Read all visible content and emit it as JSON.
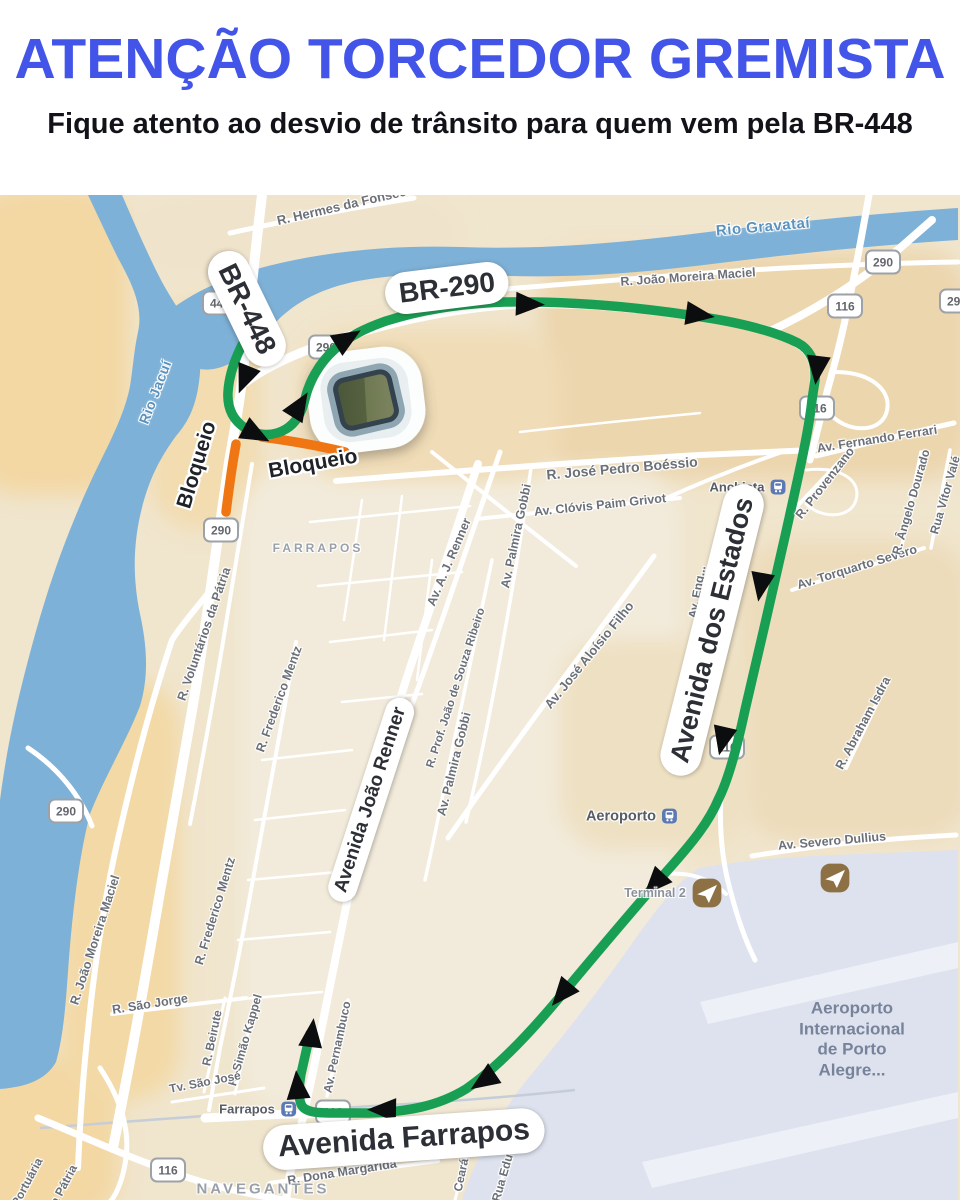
{
  "header": {
    "title": "ATENÇÃO TORCEDOR GREMISTA",
    "subtitle": "Fique atento ao desvio de trânsito para quem vem pela BR-448",
    "title_color": "#4355e8",
    "subtitle_color": "#111318"
  },
  "map": {
    "palette": {
      "base": "#f0e5cd",
      "water": "#7eb1d7",
      "airport": "#dde2ee",
      "runway": "#edf0f7",
      "road": "#ffffff",
      "route": "#199f53",
      "blocked": "#ef7612",
      "arrow": "#0c0d0f",
      "rail": "#c5cdd8"
    },
    "pills": [
      {
        "t": "BR-448",
        "x": 247,
        "y": 309,
        "r": 64,
        "s": 28
      },
      {
        "t": "BR-290",
        "x": 447,
        "y": 288,
        "r": -7,
        "s": 28
      },
      {
        "t": "Avenida dos Estados",
        "x": 712,
        "y": 630,
        "r": -76,
        "s": 27
      },
      {
        "t": "Avenida João Renner",
        "x": 371,
        "y": 800,
        "r": -72,
        "s": 19
      },
      {
        "t": "Avenida Farrapos",
        "x": 404,
        "y": 1139,
        "r": -4,
        "s": 30
      }
    ],
    "halo_labels": [
      {
        "t": "Bloqueio",
        "x": 197,
        "y": 465,
        "r": -73,
        "s": 21
      },
      {
        "t": "Bloqueio",
        "x": 313,
        "y": 464,
        "r": -10,
        "s": 21
      }
    ],
    "shields": [
      {
        "t": "448",
        "x": 220,
        "y": 303
      },
      {
        "t": "290",
        "x": 326,
        "y": 347
      },
      {
        "t": "290",
        "x": 883,
        "y": 262
      },
      {
        "t": "290",
        "x": 957,
        "y": 301
      },
      {
        "t": "116",
        "x": 845,
        "y": 306
      },
      {
        "t": "116",
        "x": 817,
        "y": 408
      },
      {
        "t": "116",
        "x": 727,
        "y": 747
      },
      {
        "t": "116",
        "x": 333,
        "y": 1112
      },
      {
        "t": "290",
        "x": 221,
        "y": 530
      },
      {
        "t": "290",
        "x": 66,
        "y": 811
      },
      {
        "t": "116",
        "x": 168,
        "y": 1170
      }
    ],
    "labels": [
      {
        "t": "R. Hermes da Fonseca",
        "x": 345,
        "y": 205,
        "r": -13,
        "s": 13,
        "c": ""
      },
      {
        "t": "R. João Moreira Maciel",
        "x": 688,
        "y": 277,
        "r": -4,
        "s": 12.5,
        "c": ""
      },
      {
        "t": "Rio Gravataí",
        "x": 763,
        "y": 227,
        "r": -5,
        "s": 15,
        "c": "lbl-water"
      },
      {
        "t": "Rio Jacuí",
        "x": 155,
        "y": 392,
        "r": -69,
        "s": 14,
        "c": "lbl-water"
      },
      {
        "t": "Av. Eng...",
        "x": 697,
        "y": 592,
        "r": -80,
        "s": 12,
        "c": ""
      },
      {
        "t": "R. José Pedro Boéssio",
        "x": 622,
        "y": 468,
        "r": -5,
        "s": 14,
        "c": ""
      },
      {
        "t": "Av. Clóvis Paim Grivot",
        "x": 600,
        "y": 505,
        "r": -6,
        "s": 12.5,
        "c": ""
      },
      {
        "t": "Av. Fernando Ferrari",
        "x": 877,
        "y": 439,
        "r": -9,
        "s": 12.5,
        "c": ""
      },
      {
        "t": "R. Provenzano",
        "x": 825,
        "y": 483,
        "r": -52,
        "s": 12.5,
        "c": ""
      },
      {
        "t": "Av. Torquarto Severo",
        "x": 857,
        "y": 567,
        "r": -17,
        "s": 12.5,
        "c": ""
      },
      {
        "t": "R. Ângelo Dourado",
        "x": 911,
        "y": 502,
        "r": -74,
        "s": 12,
        "c": ""
      },
      {
        "t": "Rua Vítor Valé",
        "x": 945,
        "y": 495,
        "r": -74,
        "s": 12,
        "c": ""
      },
      {
        "t": "R. Abraham Isdra",
        "x": 863,
        "y": 723,
        "r": -62,
        "s": 12.5,
        "c": ""
      },
      {
        "t": "Av. Severo Dullius",
        "x": 832,
        "y": 841,
        "r": -5,
        "s": 12.5,
        "c": ""
      },
      {
        "t": "R. Voluntários da Pátria",
        "x": 204,
        "y": 634,
        "r": -71,
        "s": 12.5,
        "c": ""
      },
      {
        "t": "R. Frederico Mentz",
        "x": 279,
        "y": 699,
        "r": -70,
        "s": 12.5,
        "c": ""
      },
      {
        "t": "R. Frederico Mentz",
        "x": 215,
        "y": 911,
        "r": -73,
        "s": 12.5,
        "c": ""
      },
      {
        "t": "Av. A. J. Renner",
        "x": 449,
        "y": 562,
        "r": -67,
        "s": 12.5,
        "c": ""
      },
      {
        "t": "R. Prof. João de Souza Ribeiro",
        "x": 456,
        "y": 688,
        "r": -72,
        "s": 11.5,
        "c": ""
      },
      {
        "t": "Av. Palmira Gobbi",
        "x": 516,
        "y": 536,
        "r": -78,
        "s": 12.5,
        "c": ""
      },
      {
        "t": "Av. Palmira Gobbi",
        "x": 454,
        "y": 764,
        "r": -76,
        "s": 12.5,
        "c": ""
      },
      {
        "t": "Av. José Aloísio Filho",
        "x": 589,
        "y": 655,
        "r": -51,
        "s": 13,
        "c": ""
      },
      {
        "t": "R. João Moreira Maciel",
        "x": 95,
        "y": 940,
        "r": -72,
        "s": 12.5,
        "c": ""
      },
      {
        "t": "R. São Jorge",
        "x": 150,
        "y": 1004,
        "r": -9,
        "s": 12.5,
        "c": ""
      },
      {
        "t": "R. Beirute",
        "x": 212,
        "y": 1038,
        "r": -78,
        "s": 12,
        "c": ""
      },
      {
        "t": "R. Simão Kappel",
        "x": 245,
        "y": 1040,
        "r": -74,
        "s": 12,
        "c": ""
      },
      {
        "t": "Tv. São José",
        "x": 205,
        "y": 1082,
        "r": -11,
        "s": 12,
        "c": ""
      },
      {
        "t": "Av. Pernambuco",
        "x": 337,
        "y": 1047,
        "r": -78,
        "s": 12,
        "c": ""
      },
      {
        "t": "R. Dona Margarida",
        "x": 342,
        "y": 1172,
        "r": -9,
        "s": 12.5,
        "c": ""
      },
      {
        "t": "Ceará",
        "x": 461,
        "y": 1175,
        "r": -78,
        "s": 12,
        "c": ""
      },
      {
        "t": "Rua Edu C",
        "x": 504,
        "y": 1172,
        "r": -74,
        "s": 12,
        "c": ""
      },
      {
        "t": "Portuária",
        "x": 27,
        "y": 1182,
        "r": -62,
        "s": 12,
        "c": ""
      },
      {
        "t": "da Pátria",
        "x": 62,
        "y": 1188,
        "r": -62,
        "s": 12,
        "c": ""
      },
      {
        "t": "Terminal 2",
        "x": 655,
        "y": 893,
        "r": 0,
        "s": 12.5,
        "c": "lbl-grey"
      },
      {
        "t": "FARRAPOS",
        "x": 318,
        "y": 548,
        "r": 0,
        "s": 12,
        "c": "lbl-district"
      },
      {
        "t": "NAVEGANTES",
        "x": 263,
        "y": 1189,
        "r": 0,
        "s": 15,
        "c": "lbl-district"
      }
    ],
    "pois": [
      {
        "t": "Anchieta",
        "icon": "train",
        "x": 748,
        "y": 487,
        "s": 13
      },
      {
        "t": "Aeroporto",
        "icon": "train",
        "x": 632,
        "y": 816,
        "s": 14.5
      },
      {
        "t": "Farrapos",
        "icon": "train",
        "x": 258,
        "y": 1109,
        "s": 13
      }
    ],
    "solo_icons": [
      {
        "icon": "plane",
        "x": 707,
        "y": 893,
        "s": 30
      },
      {
        "icon": "plane",
        "x": 835,
        "y": 878,
        "s": 30
      }
    ],
    "airport_block": {
      "x": 852,
      "y": 1040,
      "s": 17,
      "lines": [
        "Aeroporto",
        "Internacional",
        "de Porto",
        "Alegre..."
      ]
    },
    "arrows": [
      {
        "x": 247,
        "y": 373,
        "a": 112
      },
      {
        "x": 250,
        "y": 431,
        "a": 28
      },
      {
        "x": 296,
        "y": 411,
        "a": -58
      },
      {
        "x": 342,
        "y": 342,
        "a": -32
      },
      {
        "x": 523,
        "y": 304,
        "a": 2
      },
      {
        "x": 693,
        "y": 314,
        "a": 8
      },
      {
        "x": 818,
        "y": 363,
        "a": 97
      },
      {
        "x": 762,
        "y": 580,
        "a": 100
      },
      {
        "x": 724,
        "y": 734,
        "a": 103
      },
      {
        "x": 659,
        "y": 879,
        "a": 133
      },
      {
        "x": 566,
        "y": 989,
        "a": 130
      },
      {
        "x": 489,
        "y": 1077,
        "a": 146
      },
      {
        "x": 389,
        "y": 1110,
        "a": 181
      },
      {
        "x": 298,
        "y": 1092,
        "a": -95
      },
      {
        "x": 311,
        "y": 1040,
        "a": -83
      }
    ],
    "stadium": {
      "x": 366,
      "y": 400,
      "r": -7
    },
    "geometry": {
      "patches": [
        {
          "x": 540,
          "y": 250,
          "w": 430,
          "h": 230,
          "f": "#ecd6ae"
        },
        {
          "x": 740,
          "y": 540,
          "w": 230,
          "h": 300,
          "f": "#eddcbb"
        },
        {
          "x": -30,
          "y": 185,
          "w": 160,
          "h": 310,
          "f": "#f3d8a4"
        },
        {
          "x": -30,
          "y": 1055,
          "w": 150,
          "h": 170,
          "f": "#f3d8a4"
        },
        {
          "x": 60,
          "y": 680,
          "w": 120,
          "h": 420,
          "f": "#f3d9a6"
        },
        {
          "x": 150,
          "y": 300,
          "w": 110,
          "h": 230,
          "f": "#f2dcb0"
        },
        {
          "x": 240,
          "y": 470,
          "w": 440,
          "h": 640,
          "f": "#f2ebdb"
        },
        {
          "x": 300,
          "y": 330,
          "w": 260,
          "h": 150,
          "f": "#f0dcb6"
        },
        {
          "x": 560,
          "y": 640,
          "w": 190,
          "h": 210,
          "f": "#eee0c2"
        },
        {
          "x": 130,
          "y": 195,
          "w": 330,
          "h": 80,
          "f": "#efe3cb"
        }
      ],
      "water_jacui": "M88,195 L122,195 C135,225 148,255 162,282 C172,300 182,315 192,330 C200,342 202,360 199,382 C196,404 190,420 176,436 C160,458 148,480 140,516 C133,548 133,580 140,614 C147,646 149,676 140,706 C126,742 104,778 90,814 C80,852 73,906 69,958 C66,1000 64,1034 56,1062 C46,1080 26,1087 0,1089 L0,800 C5,762 12,724 22,684 C32,644 44,600 60,556 C74,518 88,486 102,458 C115,432 126,408 130,386 C133,368 134,350 138,332 C144,306 130,280 118,258 C108,238 98,216 88,195 Z",
      "water_gravatai": "M170,310 C200,288 235,273 285,262 C340,250 400,245 460,247 C540,250 620,243 700,233 C780,223 880,213 958,208 L958,240 C880,245 800,253 720,263 C650,272 580,278 510,276 C455,274 405,272 358,281 C322,288 296,302 278,320 C265,333 254,344 244,354 C228,368 206,374 192,366 C178,358 168,336 170,310 Z",
      "airport": "M700,868 C740,860 800,856 860,854 L958,850 L958,1200 L462,1200 C478,1152 498,1116 530,1076 C560,1040 600,990 640,932 C660,906 678,880 700,868 Z",
      "runways": [
        "M700,1002 L958,942 L958,968 L708,1024 Z",
        "M642,1162 L958,1092 L958,1118 L652,1188 Z"
      ],
      "rails": [
        "M40,1128 C150,1120 250,1112 340,1108 C430,1103 520,1096 575,1090",
        "M812,402 C804,450 792,510 779,568 C766,626 752,686 741,730"
      ],
      "roads": [
        {
          "d": "M262,195 C254,262 249,312 245,352 C241,396 236,422 229,462 L213,572 C206,622 199,672 190,722 C182,768 172,822 160,892 C148,962 136,1032 124,1092 L113,1148",
          "w": 10
        },
        {
          "d": "M209,592 C195,610 182,624 172,640 C152,700 136,760 120,830 C106,890 95,960 88,1030 C83,1075 80,1120 78,1168",
          "w": 6
        },
        {
          "d": "M28,748 C58,768 80,795 92,826",
          "w": 5
        },
        {
          "d": "M246,382 C262,370 290,355 330,342 C380,325 440,310 505,305 C575,300 660,310 730,322 C762,327 786,336 800,345 C812,353 816,365 814,385",
          "w": 9
        },
        {
          "d": "M814,385 C810,425 798,478 786,532 C774,586 758,654 745,710 C736,752 728,780 719,798 C709,822 693,842 667,871 C639,903 599,950 559,998 C524,1040 494,1070 466,1089 C438,1106 408,1112 368,1113 L288,1114 L205,1118",
          "w": 9
        },
        {
          "d": "M768,332 C820,308 862,280 900,248 L932,220",
          "w": 8
        },
        {
          "d": "M869,195 C862,235 856,268 848,306 C842,336 836,360 828,388 C822,412 816,436 810,460",
          "w": 7
        },
        {
          "d": "M721,794 C719,830 722,862 731,893 C737,916 745,940 755,960",
          "w": 5
        },
        {
          "d": "M230,233 C290,220 350,208 414,198",
          "w": 5
        },
        {
          "d": "M480,291 C570,284 660,276 750,270 C820,266 890,263 958,262",
          "w": 5
        },
        {
          "d": "M336,481 C460,471 580,462 700,455 L814,450",
          "w": 6
        },
        {
          "d": "M476,519 C545,512 612,505 680,498",
          "w": 4
        },
        {
          "d": "M478,464 C455,535 433,600 410,668 C392,722 374,788 356,862 C342,922 327,1002 313,1072 L302,1122 L290,1174 L286,1200",
          "w": 8
        },
        {
          "d": "M500,452 C480,510 462,562 442,620 C425,668 408,718 390,764",
          "w": 5
        },
        {
          "d": "M492,560 C478,630 462,700 448,770 C440,808 433,845 425,880",
          "w": 3.5
        },
        {
          "d": "M531,468 C521,540 509,610 496,680 C487,728 477,776 466,822",
          "w": 3.5
        },
        {
          "d": "M654,556 C612,614 566,674 521,736 C496,770 471,805 448,838",
          "w": 5
        },
        {
          "d": "M786,518 L860,440",
          "w": 4
        },
        {
          "d": "M792,590 C836,576 880,563 924,548",
          "w": 4
        },
        {
          "d": "M921,452 L901,550",
          "w": 3.5
        },
        {
          "d": "M950,450 L931,548",
          "w": 3.5
        },
        {
          "d": "M816,456 C862,445 908,433 954,423",
          "w": 5
        },
        {
          "d": "M886,684 L846,768",
          "w": 4
        },
        {
          "d": "M752,856 C820,845 880,839 956,835",
          "w": 5
        },
        {
          "d": "M662,500 C702,482 742,466 782,452",
          "w": 4
        },
        {
          "d": "M252,464 C243,522 233,582 223,642 C213,702 202,762 190,824",
          "w": 4
        },
        {
          "d": "M296,642 C283,718 268,796 254,874 C244,930 232,990 220,1048 L209,1110",
          "w": 4
        },
        {
          "d": "M112,1014 L246,998",
          "w": 4
        },
        {
          "d": "M225,998 L204,1092",
          "w": 3
        },
        {
          "d": "M255,1000 L235,1094",
          "w": 3
        },
        {
          "d": "M172,1102 L264,1088",
          "w": 3
        },
        {
          "d": "M348,1000 C341,1032 334,1064 327,1096",
          "w": 3.5
        },
        {
          "d": "M270,1183 C325,1175 380,1169 438,1161",
          "w": 4
        },
        {
          "d": "M471,1138 L455,1200",
          "w": 3
        },
        {
          "d": "M513,1132 L497,1200",
          "w": 3
        },
        {
          "d": "M836,372 C872,372 894,392 886,414 C878,434 846,432 830,414",
          "w": 4
        },
        {
          "d": "M806,470 C840,466 862,480 856,500 C850,520 820,518 806,504",
          "w": 3
        },
        {
          "d": "M666,874 C692,872 712,880 726,894",
          "w": 4
        },
        {
          "d": "M38,1118 C92,1140 142,1164 202,1182 C242,1193 272,1198 302,1203",
          "w": 7
        },
        {
          "d": "M100,1068 C120,1098 130,1128 126,1158 C123,1180 116,1196 109,1203",
          "w": 5
        },
        {
          "d": "M432,452 C482,492 532,532 576,566",
          "w": 4
        },
        {
          "d": "M310,522 L470,506",
          "w": 2.5
        },
        {
          "d": "M318,586 L462,572",
          "w": 2.5
        },
        {
          "d": "M330,642 L432,630",
          "w": 2.5
        },
        {
          "d": "M342,702 L422,694",
          "w": 2.5
        },
        {
          "d": "M362,500 L344,620",
          "w": 2.5
        },
        {
          "d": "M402,496 L384,640",
          "w": 2.5
        },
        {
          "d": "M432,560 L417,680",
          "w": 2.5
        },
        {
          "d": "M262,760 L352,750",
          "w": 2.5
        },
        {
          "d": "M255,820 L345,810",
          "w": 2.5
        },
        {
          "d": "M248,880 L338,872",
          "w": 2.5
        },
        {
          "d": "M238,940 L330,932",
          "w": 2.5
        },
        {
          "d": "M231,1000 L322,992",
          "w": 2.5
        },
        {
          "d": "M520,432 C580,425 640,419 700,413",
          "w": 2.5
        }
      ],
      "route_detour": "M242,345 C235,359 229,375 228,392 C227,408 233,420 245,428 C257,436 273,437 286,429 C296,423 302,412 305,399 C309,382 319,363 335,349 C349,336 366,328 386,321 C421,310 456,304 505,302 C575,301 645,308 702,317 C742,323 776,332 798,343 C811,350 816,362 815,380 L812,400 C809,430 798,478 786,532 C774,586 758,654 745,710 C736,752 728,780 719,798 C709,822 693,842 667,871 C639,903 599,950 559,998 C524,1040 494,1070 466,1089 C438,1106 408,1112 368,1113 L332,1113 C316,1113 304,1112 301,1104 C298,1096 299,1086 301,1074 L310,1034",
      "route_blocked": [
        "M262,437 C292,441 320,446 345,452",
        "M236,444 C232,466 229,488 226,512"
      ]
    }
  }
}
